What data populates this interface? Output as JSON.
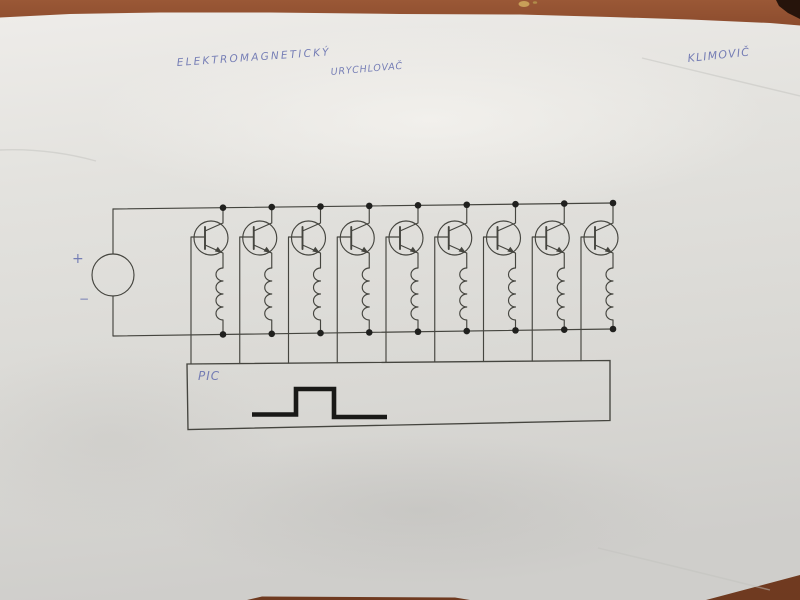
{
  "photo": {
    "handwriting": {
      "title_line1": "ELEKTROMAGNETICKÝ",
      "title_line2": "URYCHLOVAČ",
      "author": "KLIMOVIČ"
    },
    "colors": {
      "desk_wood": "#8a4a2c",
      "paper": "#e0dfdb",
      "ink_blue": "#6d76b2",
      "pencil_line": "#45453f",
      "junction_dot": "#20201e",
      "pulse_black": "#191917"
    }
  },
  "circuit": {
    "type": "hand-drawn schematic",
    "description": "Nine transistor-switched coil stages on a common DC supply, bases driven from a PIC controller emitting one rectangular pulse",
    "power_source": {
      "symbol": "dc-source-circle",
      "plus": "+",
      "minus": "−"
    },
    "stage_count": 9,
    "stage": {
      "transistor": "NPN",
      "load": "coil",
      "coil_bumps": 4
    },
    "controller": {
      "label": "PIC",
      "waveform": "low-high-low single pulse"
    }
  }
}
